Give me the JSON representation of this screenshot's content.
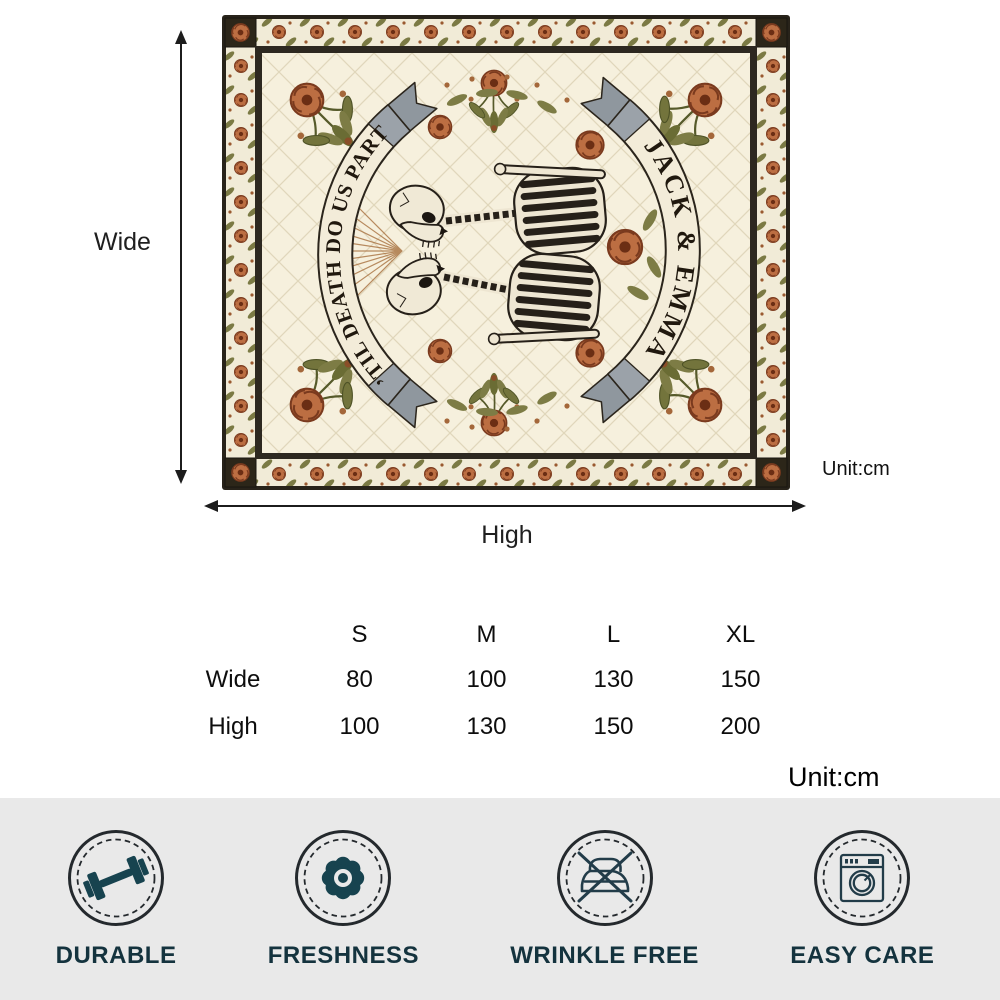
{
  "preview": {
    "banner_left_text": "’TIL DEATH DO US PART",
    "banner_right_text": "JACK & EMMA",
    "art_description": "Kissing skeleton couple among rust roses and olive foliage on a quilted cream blanket with rose-vine border"
  },
  "dimension_guide": {
    "wide_label": "Wide",
    "high_label": "High",
    "unit_label": "Unit:cm"
  },
  "size_table": {
    "unit_label": "Unit:cm",
    "columns": [
      "S",
      "M",
      "L",
      "XL"
    ],
    "rows": [
      {
        "label": "Wide",
        "values": [
          "80",
          "100",
          "130",
          "150"
        ]
      },
      {
        "label": "High",
        "values": [
          "100",
          "130",
          "150",
          "200"
        ]
      }
    ]
  },
  "features": {
    "items": [
      {
        "label": "DURABLE",
        "icon": "dumbbell-icon"
      },
      {
        "label": "FRESHNESS",
        "icon": "flower-icon"
      },
      {
        "label": "WRINKLE FREE",
        "icon": "no-iron-icon"
      },
      {
        "label": "EASY CARE",
        "icon": "washing-machine-icon"
      }
    ]
  },
  "colors": {
    "feature_accent": "#17434f",
    "feature_outline": "#223c49",
    "feature_label": "#14333e",
    "feature_bar_bg": "#e9e9e9",
    "rose": "#bc6e42",
    "leaf": "#73743c",
    "quilt_base": "#f6f0dd",
    "quilt_binding": "#28231a"
  },
  "chart_data": {
    "type": "table",
    "title": "Quilt size chart",
    "unit": "cm",
    "columns": [
      "S",
      "M",
      "L",
      "XL"
    ],
    "rows": [
      {
        "label": "Wide",
        "values": [
          80,
          100,
          130,
          150
        ]
      },
      {
        "label": "High",
        "values": [
          100,
          130,
          150,
          200
        ]
      }
    ]
  }
}
